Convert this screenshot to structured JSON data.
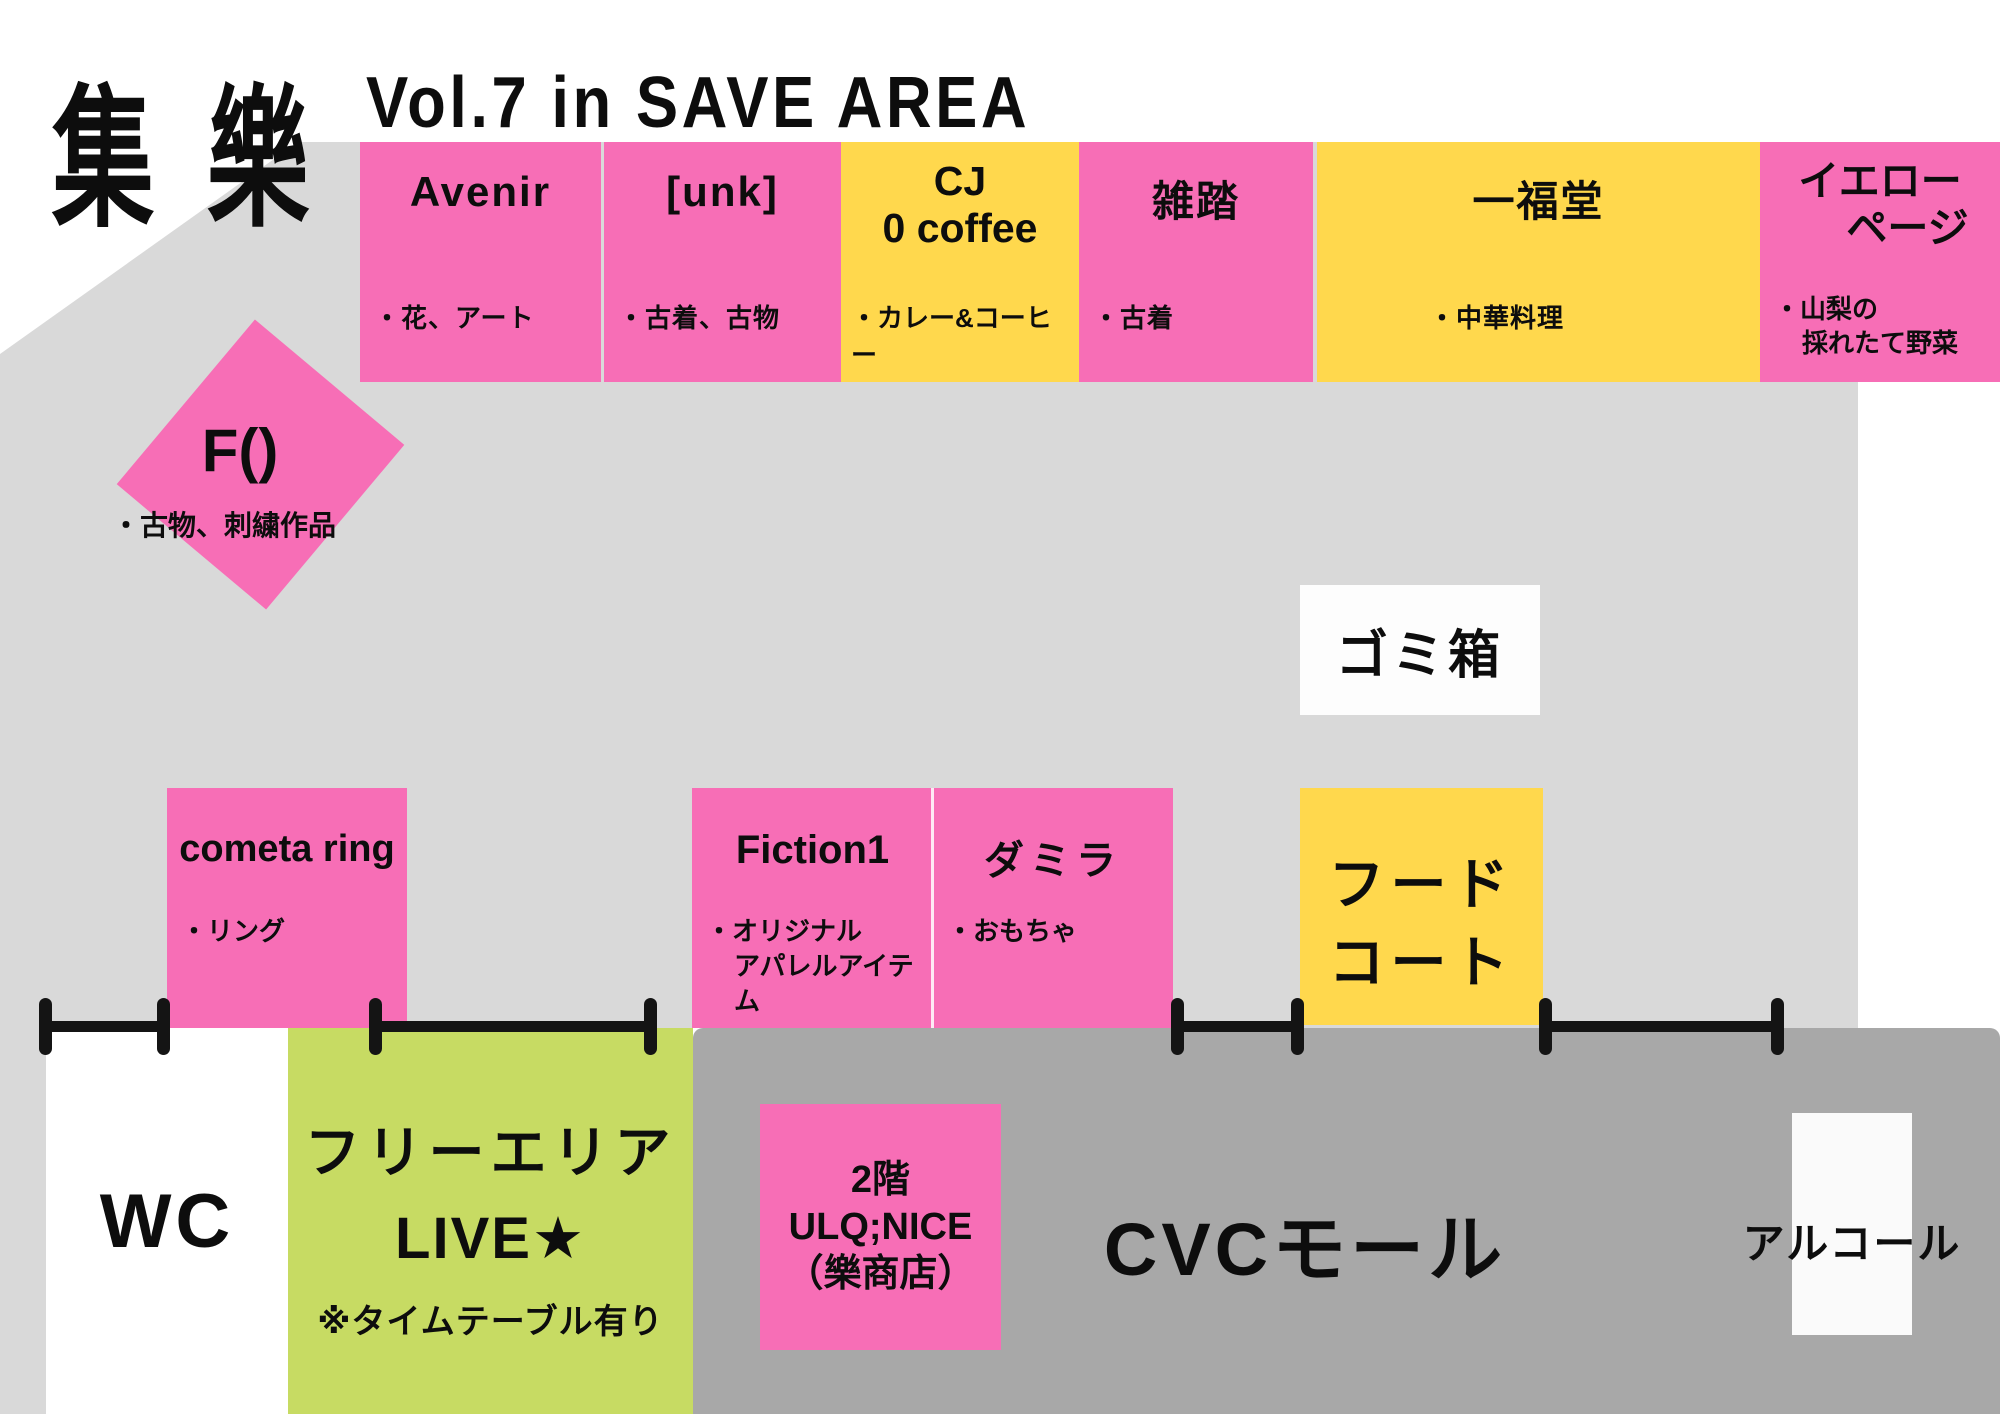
{
  "header": {
    "logo": "集 樂",
    "title": "Vol.7 in SAVE AREA"
  },
  "colors": {
    "booth_pink": "#f76eb6",
    "booth_yellow": "#ffd84d",
    "floor_light_gray": "#d9d9d9",
    "mall_dark_gray": "#a8a8a8",
    "free_area_green": "#c7db63",
    "line_black": "#141414"
  },
  "top_row": [
    {
      "name": "Avenir",
      "category": "・花、アート"
    },
    {
      "name": "[unk]",
      "category": "・古着、古物"
    },
    {
      "name_line1": "CJ",
      "name_line2": "0 coffee",
      "category": "・カレー&コーヒー"
    },
    {
      "name": "雑踏",
      "category": "・古着"
    },
    {
      "name": "一福堂",
      "category": "・中華料理"
    },
    {
      "name_line1": "イエロー",
      "name_line2": "ページ",
      "category_line1": "・山梨の",
      "category_line2": "採れたて野菜"
    }
  ],
  "f_booth": {
    "name": "F()",
    "category": "・古物、刺繍作品"
  },
  "trash_label": "ゴミ箱",
  "middle_row": {
    "cometa": {
      "name": "cometa ring",
      "category": "・リング"
    },
    "fiction": {
      "name": "Fiction1",
      "category_line1": "・オリジナル",
      "category_line2": "アパレルアイテム"
    },
    "damira": {
      "name": "ダミラ",
      "category": "・おもちゃ"
    },
    "food_court_line1": "フード",
    "food_court_line2": "コート"
  },
  "bottom": {
    "wc": "WC",
    "free_area_line1": "フリーエリア",
    "free_area_line2": "LIVE★",
    "free_area_line3": "※タイムテーブル有り",
    "ulq_line1": "2階",
    "ulq_line2": "ULQ;NICE",
    "ulq_line3": "（樂商店）",
    "mall": "CVCモール",
    "alcohol": "アルコール"
  }
}
